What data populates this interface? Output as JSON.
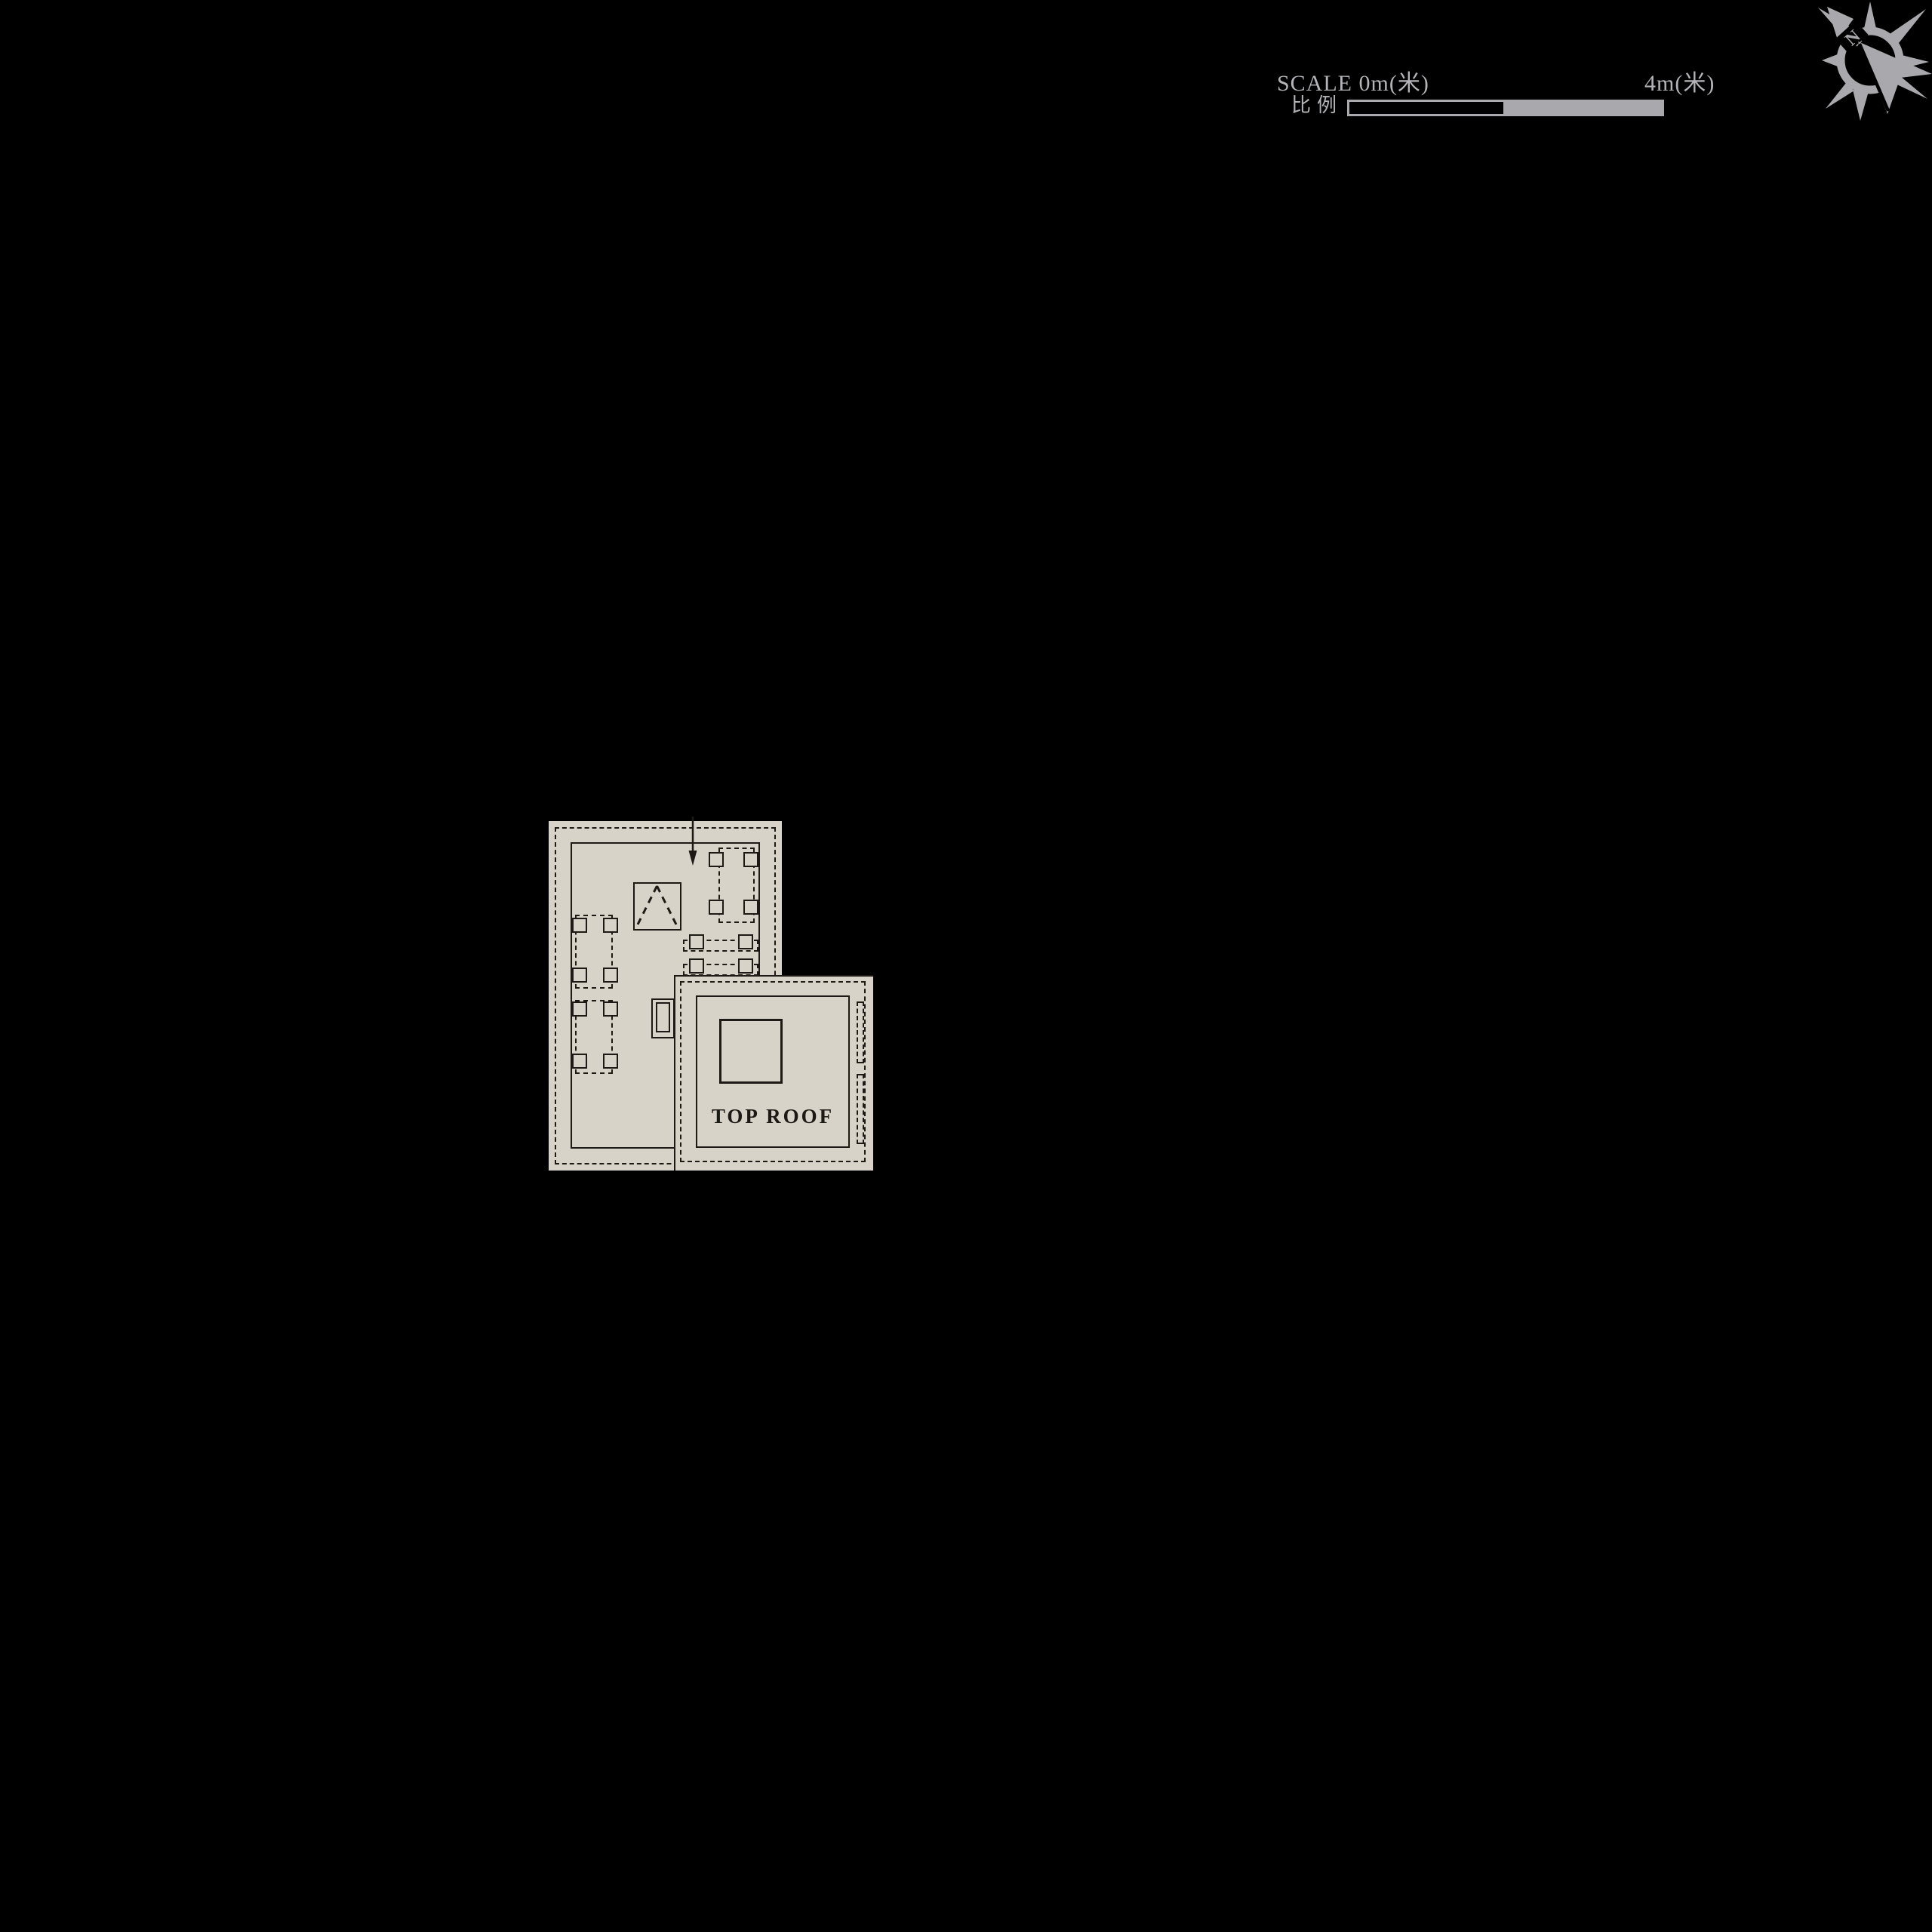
{
  "scalebar": {
    "left_label": "SCALE 0m(米)",
    "cn_label": "比例",
    "right_label": "4m(米)"
  },
  "plan": {
    "roof_label": "TOP ROOF"
  },
  "compass": {
    "north_letter": "N"
  },
  "colors": {
    "background": "#000000",
    "plan_fill": "#d8d3c9",
    "line": "#1d1a15",
    "gray": "#a9a9ad",
    "label_gray": "#b4b4b8"
  }
}
